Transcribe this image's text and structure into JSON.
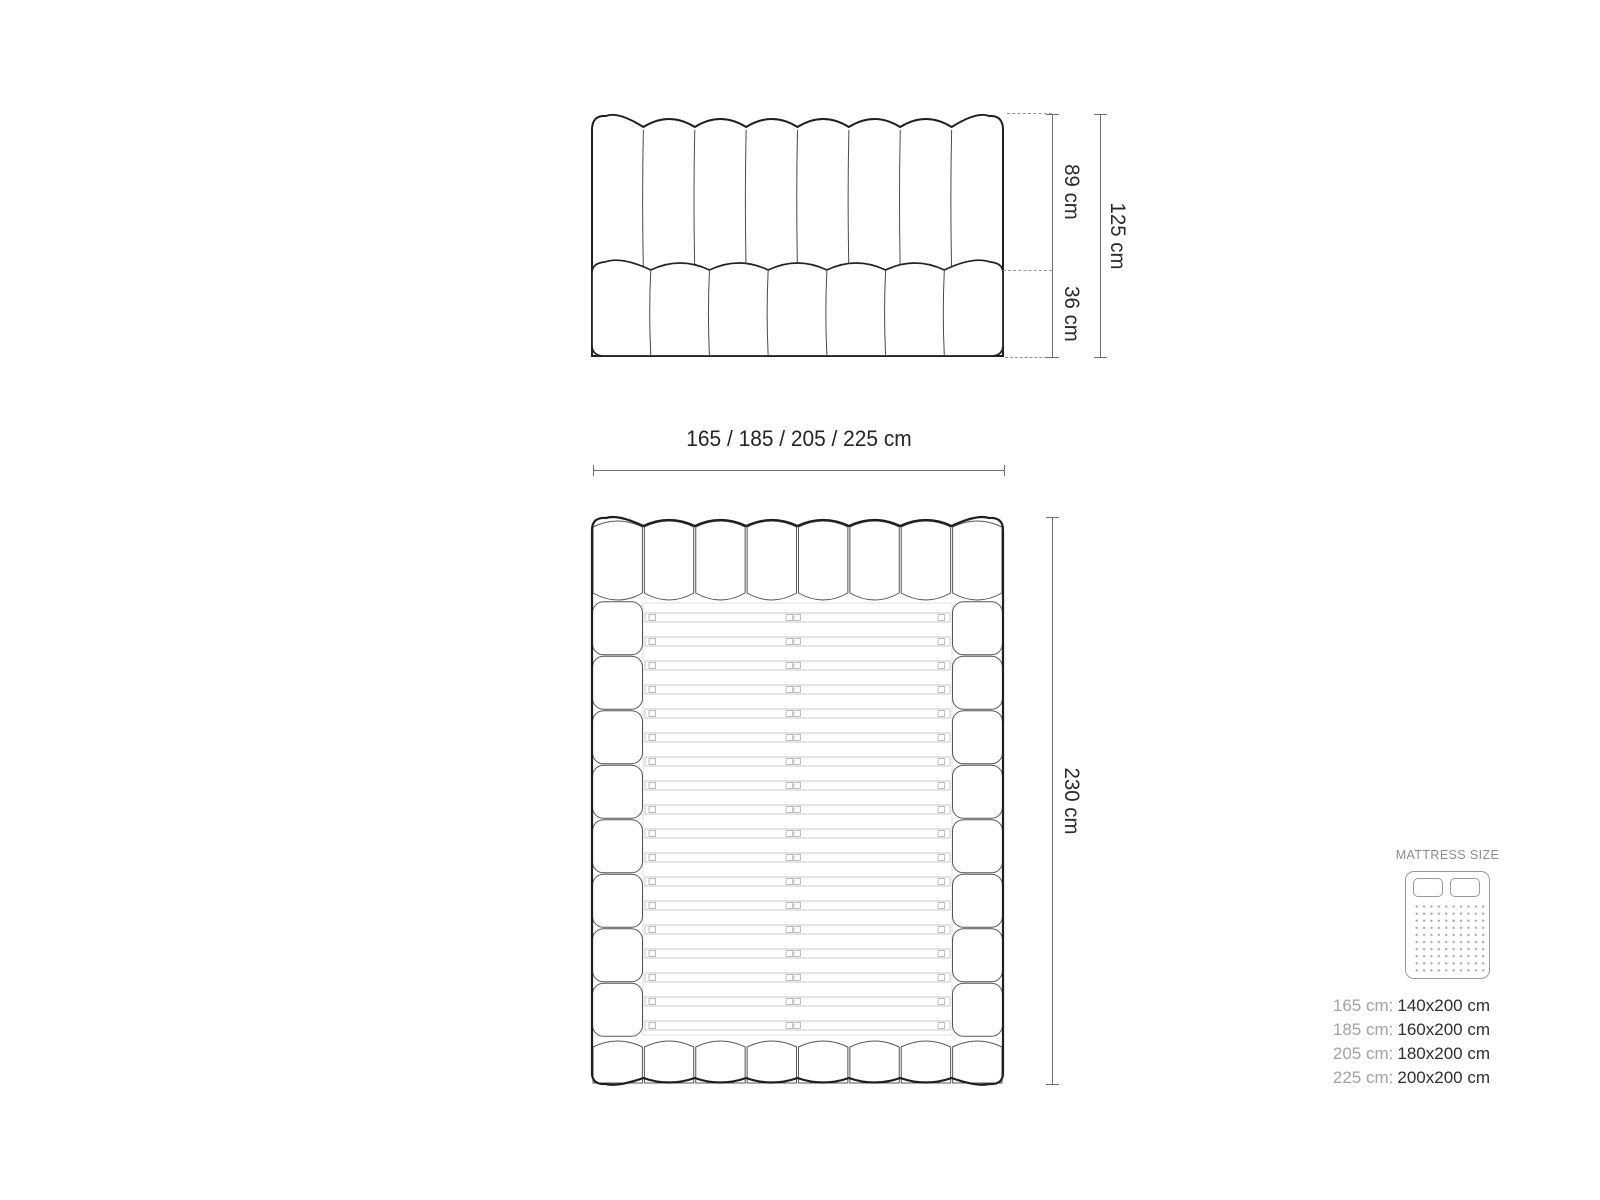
{
  "front_view": {
    "headboard_channels": 8,
    "mattress_lobes": 7,
    "labels": {
      "upper": "89 cm",
      "lower": "36 cm",
      "total": "125 cm"
    }
  },
  "width_label": "165 / 185 / 205 / 225 cm",
  "plan_view": {
    "header_segments": 8,
    "footer_segments": 8,
    "side_segments": 8,
    "slats": 18,
    "label_length": "230 cm"
  },
  "legend": {
    "title": "MATTRESS SIZE",
    "rows": [
      {
        "label": "165 cm:",
        "value": "140x200 cm"
      },
      {
        "label": "185 cm:",
        "value": "160x200 cm"
      },
      {
        "label": "205 cm:",
        "value": "180x200 cm"
      },
      {
        "label": "225 cm:",
        "value": "200x200 cm"
      }
    ]
  },
  "colors": {
    "outline": "#1f1f1f",
    "divider": "#4a4a4a",
    "thin_edge": "#555555",
    "slat": "#c9c9c9",
    "slat_clip": "#bdbdbd",
    "slat_frame": "#e2e2e2",
    "dim_line": "#6e6e6e",
    "dim_text": "#2b2b2b",
    "legend_muted": "#a3a3a3",
    "legend_value": "#2e2e2e"
  }
}
